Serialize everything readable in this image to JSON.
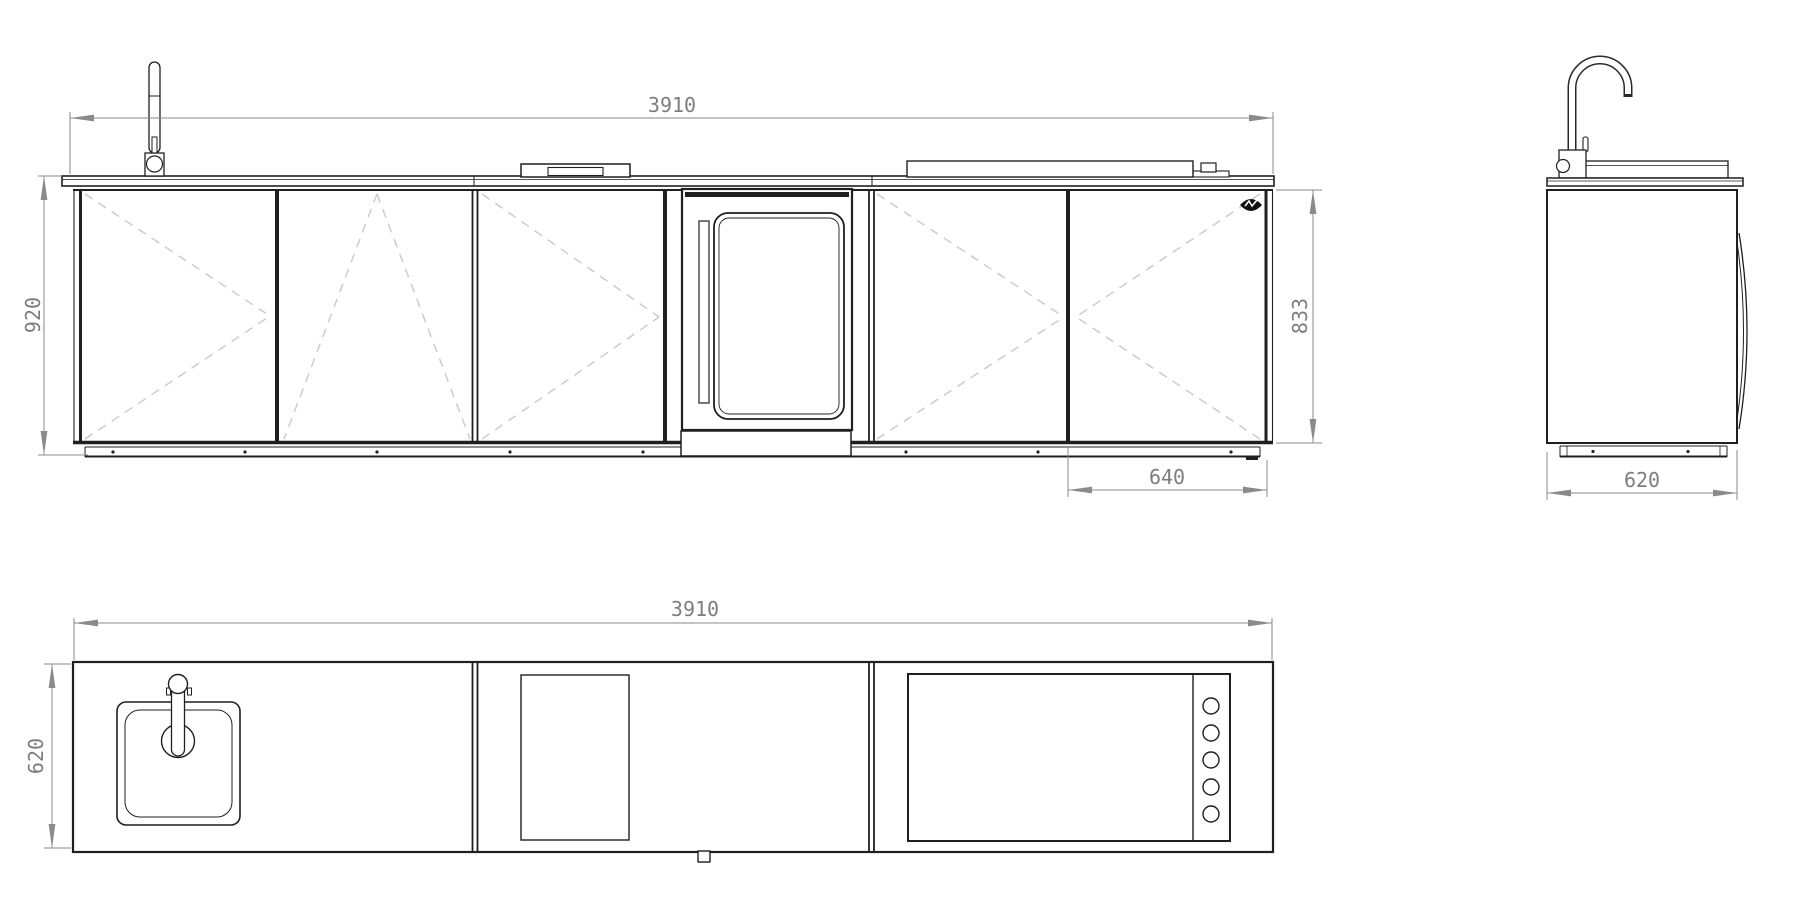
{
  "document_type": "kitchen-cabinet-technical-drawing",
  "colors": {
    "line": "#1f1f1f",
    "dimension": "#7d7d7d",
    "door_swing_dash": "#c9c9c9",
    "background": "#ffffff"
  },
  "views": {
    "front_elevation": {
      "dimensions": {
        "total_width": "3910",
        "overall_height": "920",
        "cabinet_height": "833",
        "right_module_width": "640"
      }
    },
    "side_elevation": {
      "dimensions": {
        "depth": "620"
      }
    },
    "plan_view": {
      "dimensions": {
        "total_width": "3910",
        "depth": "620"
      }
    }
  },
  "icons": {
    "faucet": "gooseneck-tap-outline",
    "sink": "rounded-square-basin",
    "oven": "glass-door-oven",
    "cooktop": "recessed-teppan",
    "grill": "lid-with-knob",
    "grill_knobs": "five-circles",
    "brand_logo": "black-leaf-mark"
  }
}
